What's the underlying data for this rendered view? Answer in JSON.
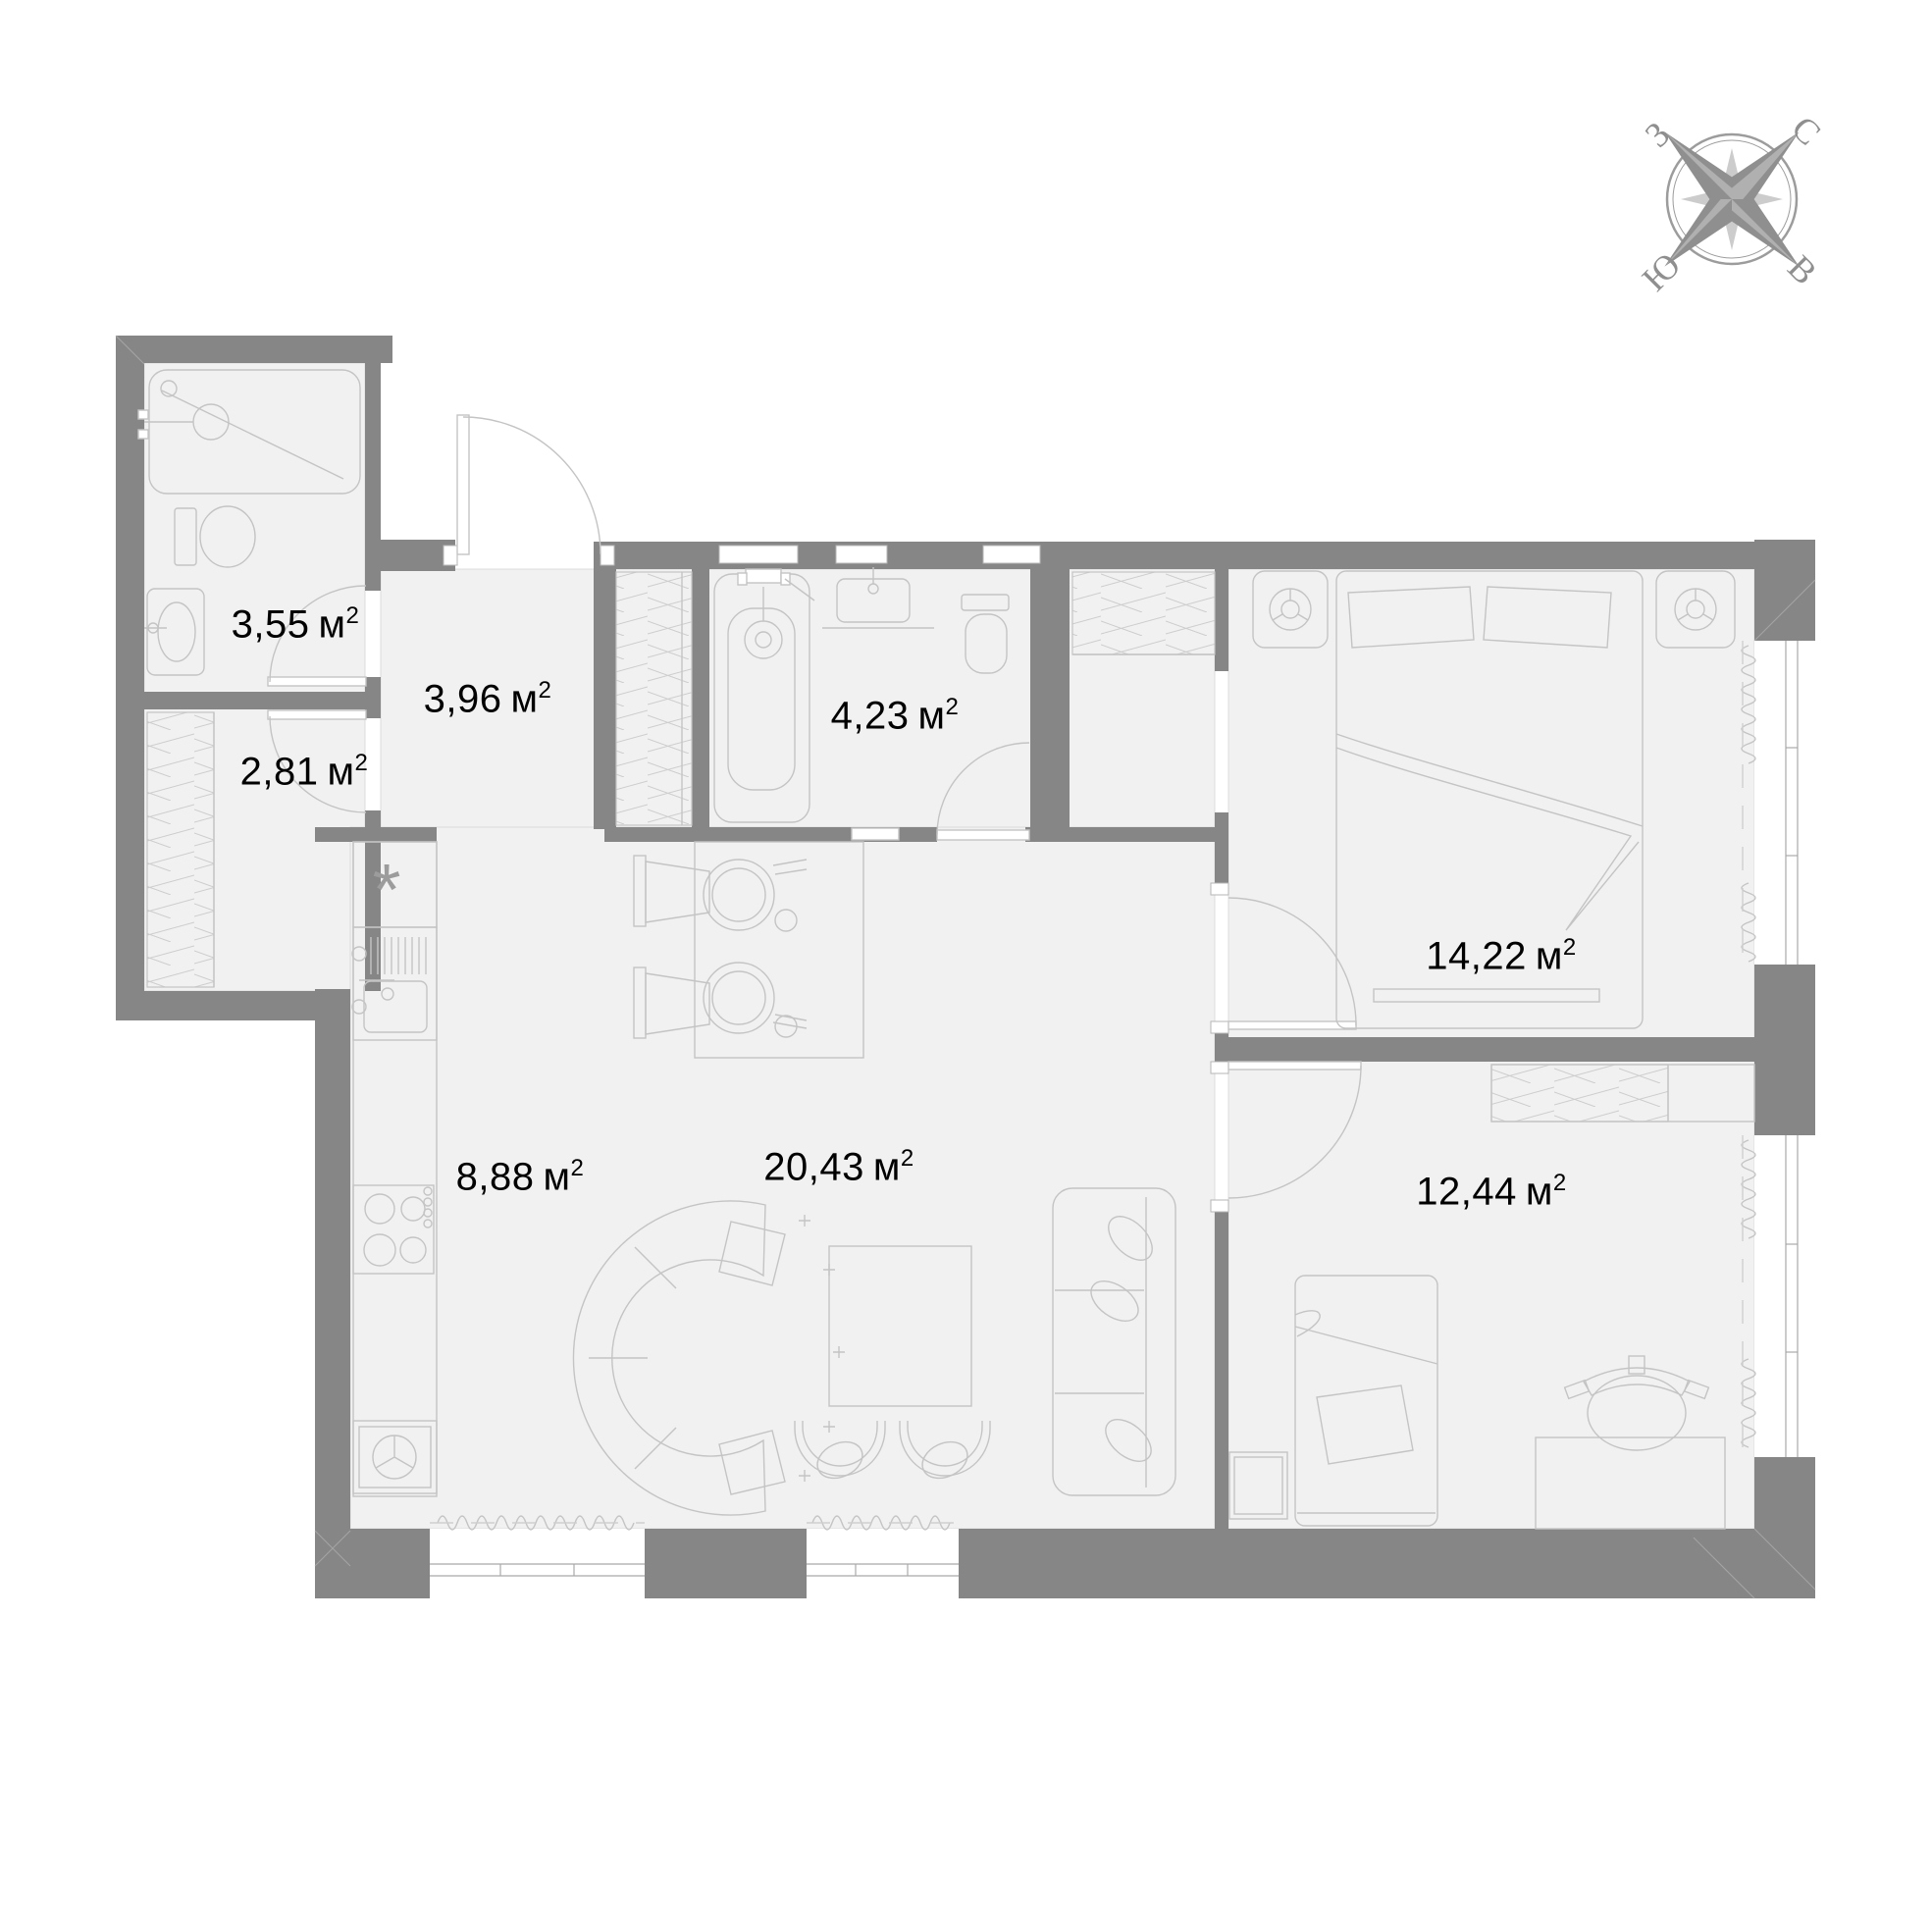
{
  "colors": {
    "wall": "#868686",
    "floor": "#f1f1f1",
    "furniture_line": "#c4c4c4",
    "detail_line": "#cfcfcf",
    "label_text": "#000000",
    "compass": "#8f8f8f",
    "background": "#ffffff"
  },
  "units": {
    "area_unit": "м",
    "sup": "2"
  },
  "compass": {
    "north": "С",
    "east": "В",
    "south": "Ю",
    "west": "З"
  },
  "kitchen": {
    "marker": "*"
  },
  "rooms": [
    {
      "id": "shower-room",
      "area": "3,55"
    },
    {
      "id": "hallway",
      "area": "3,96"
    },
    {
      "id": "storage",
      "area": "2,81"
    },
    {
      "id": "bathroom",
      "area": "4,23"
    },
    {
      "id": "bedroom-main",
      "area": "14,22"
    },
    {
      "id": "kitchen",
      "area": "8,88"
    },
    {
      "id": "living-room",
      "area": "20,43"
    },
    {
      "id": "bedroom-second",
      "area": "12,44"
    }
  ]
}
